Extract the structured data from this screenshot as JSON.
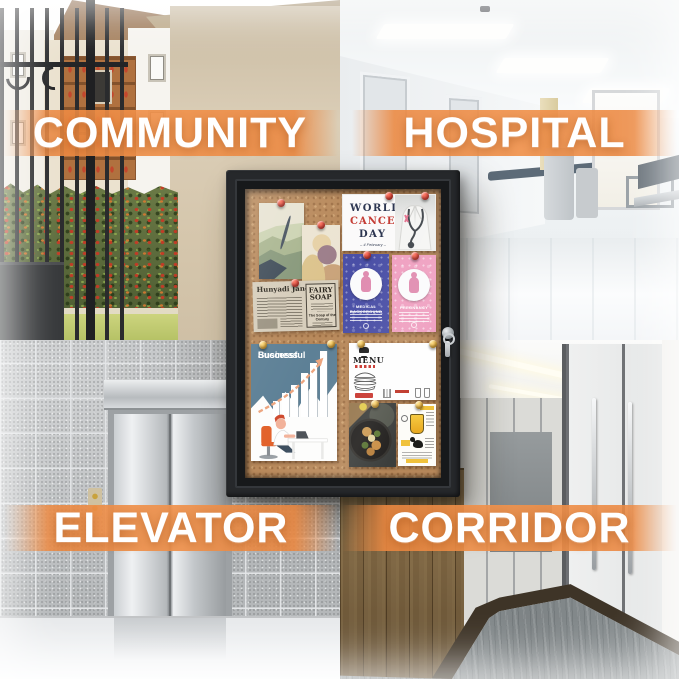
{
  "labels": {
    "community": "COMMUNITY",
    "hospital": "HOSPITAL",
    "elevator": "ELEVATOR",
    "corridor": "CORRIDOR"
  },
  "board": {
    "cancer": {
      "line1": "WORLD",
      "line2": "CANCER",
      "line3": "DAY",
      "date": "– 4 February –"
    },
    "medical": {
      "title": "MEDICAL BACKGROUND"
    },
    "pregnancy": {
      "title": "PREGNANCY"
    },
    "newspaper": {
      "headline": "Hunyadi János",
      "ad_title": "FAIRY SOAP",
      "ad_subtitle": "The Soap of the Century"
    },
    "business": {
      "title_line1": "Successful",
      "title_line2": "Business"
    },
    "menu": {
      "title": "MENU"
    }
  },
  "colors": {
    "accent_orange": "#ED8A45",
    "label_text": "#FFFFFF",
    "cork": "#B8895B",
    "frame_black": "#25272A",
    "pin_red": "#D5352A",
    "pin_yellow": "#E9B23A",
    "cancer_red": "#C43B33",
    "medical_blue": "#4A4FA6",
    "pregnancy_pink": "#EF9FC0",
    "business_blue": "#5D8096"
  }
}
